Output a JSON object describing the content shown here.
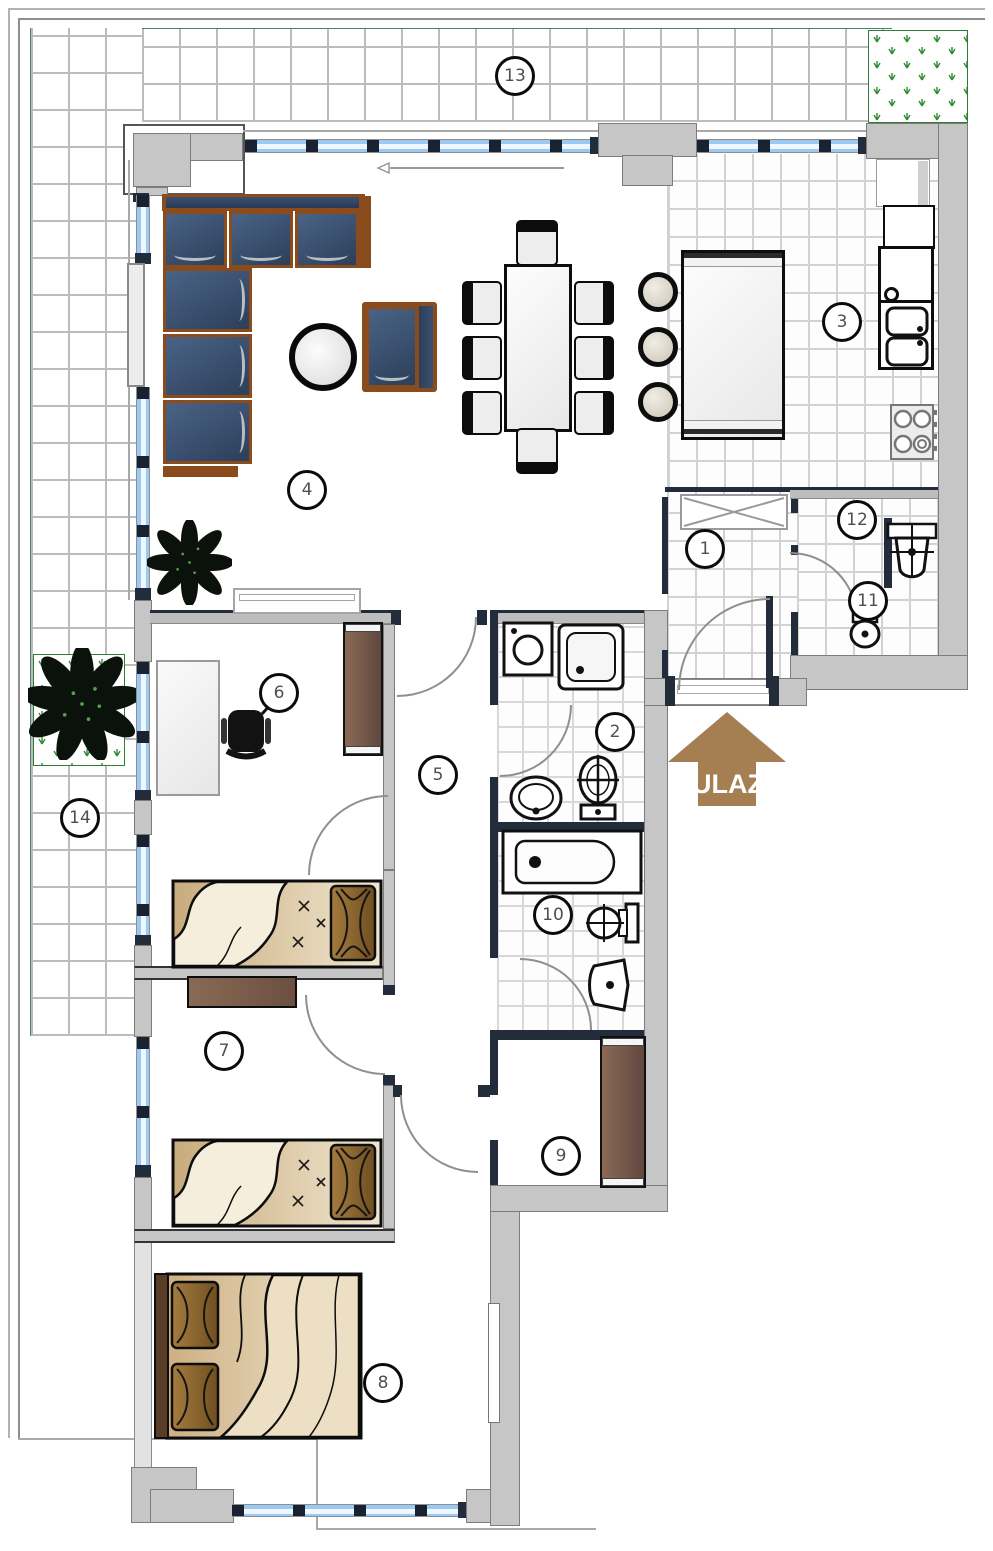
{
  "plan": {
    "entrance": {
      "label": "ULAZ"
    },
    "rooms": [
      {
        "number": "1"
      },
      {
        "number": "2"
      },
      {
        "number": "3"
      },
      {
        "number": "4"
      },
      {
        "number": "5"
      },
      {
        "number": "6"
      },
      {
        "number": "7"
      },
      {
        "number": "8"
      },
      {
        "number": "9"
      },
      {
        "number": "10"
      },
      {
        "number": "11"
      },
      {
        "number": "12"
      },
      {
        "number": "13"
      },
      {
        "number": "14"
      }
    ]
  },
  "colors": {
    "wall": "#c6c6c6",
    "partition": "#222c3a",
    "window_glass": "#9cc9f2",
    "window_post": "#182230",
    "sofa_cushion": "#3a516f",
    "sofa_frame": "#8a4c1d",
    "furniture_brown": "#6f5246",
    "bed_blanket": "#e0cba4",
    "pillow_brown": "#8a6434",
    "entrance_arrow": "#a57e52",
    "grass": "#2f8c33",
    "tile_line": "#bcbcbc"
  }
}
